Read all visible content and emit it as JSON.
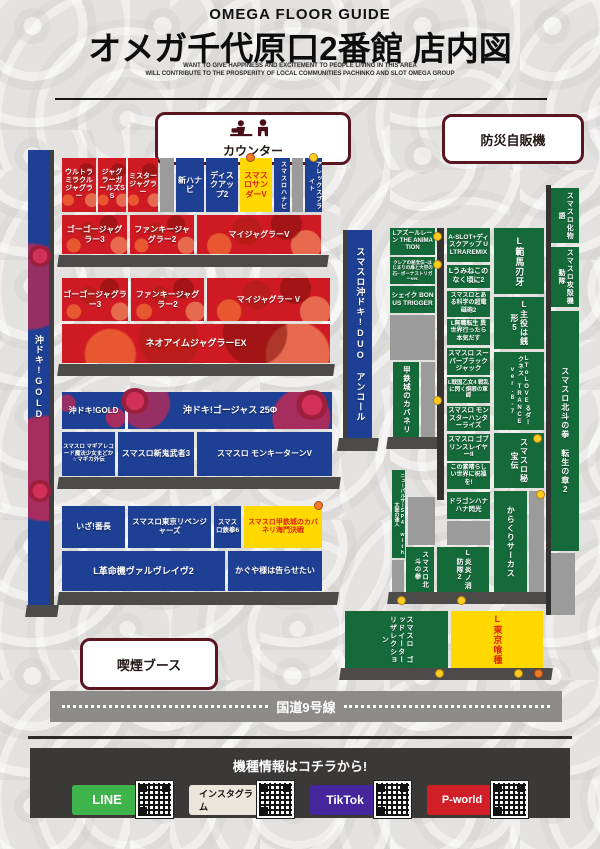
{
  "header": {
    "eyebrow": "OMEGA FLOOR GUIDE",
    "title": "オメガ千代原口2番館 店内図",
    "tagline1": "WANT TO GIVE HAPPINESS AND EXCITEMENT TO PEOPLE LIVING IN THIS AREA",
    "tagline2": "WILL CONTRIBUTE TO THE PROSPERITY OF LOCAL COMMUNITIES PACHINKO AND SLOT OMEGA GROUP"
  },
  "facilities": {
    "counter": "カウンター",
    "vending": "防災自販機",
    "smoking": "喫煙ブース",
    "road": "国道9号線"
  },
  "strips": {
    "left": "沖ドキ!GOLD",
    "mid": "スマスロ沖ドキ!DUO アンコール",
    "right1": "スマスロ化物語",
    "right2": "スマスロ攻殻機動隊",
    "right3": "スマスロ北斗の拳 転生の章2"
  },
  "m": {
    "ultra_miracle_juggler": "ウルトラミラクルジャグラー",
    "juggler_girls_ss": "ジャグラーガールズSS",
    "mister_juggler": "ミスタージャグラー",
    "shin_hanabi": "新ハナビ",
    "disc_up2": "ディスクアップ2",
    "thunder_v": "スマスロサンダーV",
    "hanabi": "スマスロハナビ",
    "alexis": "アレックスブライト",
    "gogo3_a": "ゴーゴージャグラー3",
    "funky2_a": "ファンキージャグラー2",
    "myjuggler_a": "マイジャグラーV",
    "gogo3_b": "ゴーゴージャグラー3",
    "funky2_b": "ファンキージャグラー2",
    "myjuggler_b": "マイジャグラー V",
    "neo_aim_ex": "ネオアイムジャグラーEX",
    "okidoki_gold": "沖ドキ!GOLD",
    "okidoki_gorgeous": "沖ドキ!ゴージャス 25Φ",
    "magia_record": "スマスロ マギアレコード魔法少女まどか☆マギカ外伝",
    "shin_onimusha3": "スマスロ新鬼武者3",
    "monkey_turn_v": "スマスロ モンキーターンV",
    "iza_bancho": "いざ!番長",
    "tokyo_revengers": "スマスロ東京リベンジャーズ",
    "tekken6": "スマスロ鉄拳6",
    "kabaneri_kaimon": "スマスロ甲鉄城のカバネリ海門決戦",
    "valvrave2": "L革命機ヴァルヴレイヴ2",
    "kaguya": "かぐや様は告らせたい",
    "azurlane": "Lアズールレーン THE ANIMATION",
    "crea": "クレアの秘宝伝~はじまりの扉と大空の石~ ボーナストリガーver.",
    "shake_bt": "シェイク BONUS TRIGGER",
    "kabaneri_v": "甲鉄城のカバネリ",
    "aslot_discup": "A-SLOT+ディスクアップ ULTRAREMIX",
    "umineko2": "Lうみねこのなく頃に2",
    "railgun2": "スマスロとある科学の超電磁砲2",
    "mushoku": "L無職転生 異世界行ったら本気だす",
    "super_bj": "スマスロ スーパーブラックジャック",
    "otome4": "L戦国乙女4 戦乱に閃く炯眼の軍師",
    "monhan_rise": "スマスロ モンスターハンターライズ",
    "goblin2": "スマスロ ゴブリンスレイヤーII",
    "konosuba": "この素晴らしい世界に祝福を!",
    "dragon_hanahana": "ドラゴンハナハナ閃光",
    "baki": "L範馬刃牙",
    "zenigata5": "L主役は銭形5",
    "tolove_trance": "LToLOVEるダークネス TRANCE ver.8-7",
    "hihouden": "スマスロ秘宝伝",
    "karakuri": "からくりサーカス",
    "new_pulsar": "ニューパルサーSP4 with太鼓の達人",
    "hokuto": "スマスロ北斗の拳",
    "enen2": "L炎炎ノ消防隊2",
    "god_eater": "スマスロ ゴッドイーターリザレクション",
    "tokyo_ghoul": "L東京喰種"
  },
  "footer": {
    "title": "機種情報はコチラから!",
    "badges": [
      {
        "label": "LINE"
      },
      {
        "label": "インスタグラム"
      },
      {
        "label": "TikTok"
      },
      {
        "label": "P-world"
      }
    ]
  },
  "colors": {
    "juggler_red": "#cf1a24",
    "machine_blue": "#1d3f94",
    "machine_yellow": "#ffd800",
    "machine_green": "#156a3a",
    "border_maroon": "#5a1620",
    "line_green": "#3db54a",
    "tiktok_purple": "#46269b",
    "pworld_red": "#d01f26"
  }
}
